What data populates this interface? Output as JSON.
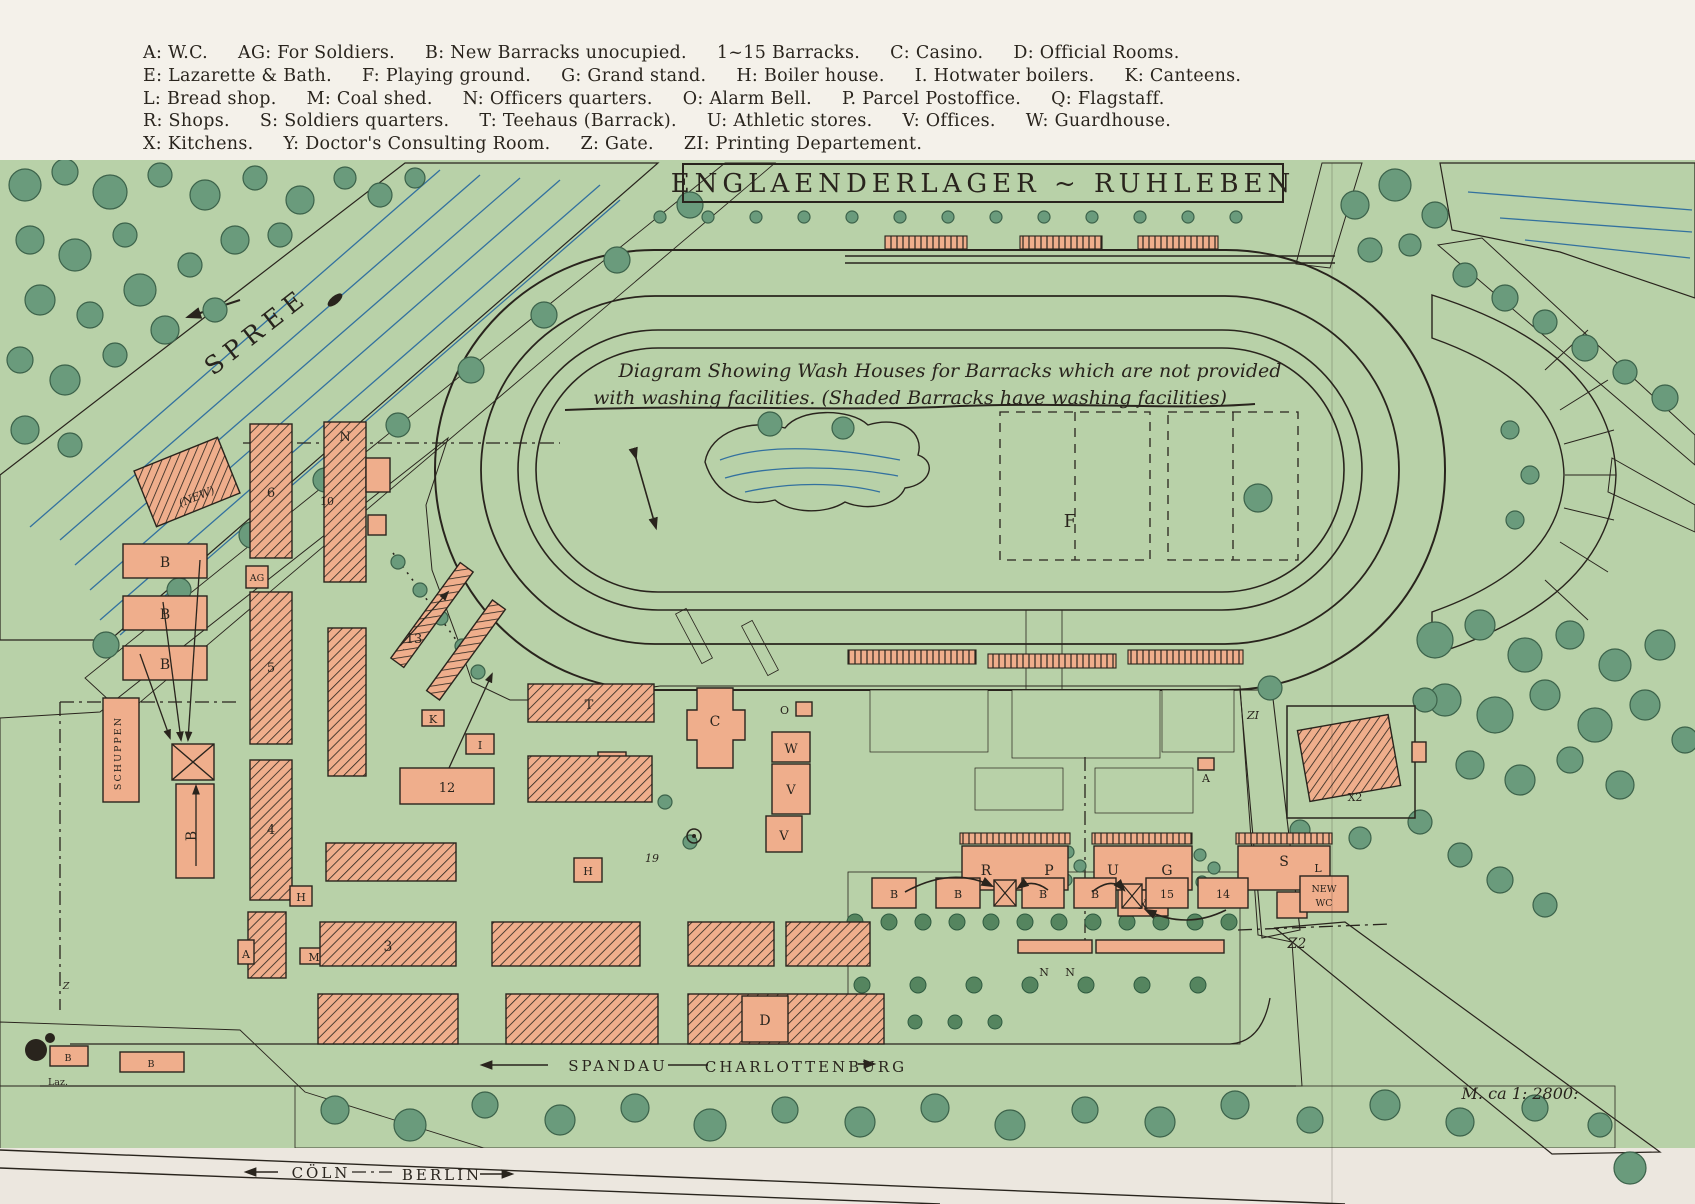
{
  "colors": {
    "paper": "#ece7df",
    "legend_paper": "#f4f1ea",
    "green": "#b8d1a8",
    "tree": "#6a9b7c",
    "bush": "#55855f",
    "water": "#7fc3e9",
    "water_line": "#33719f",
    "building": "#efae8c",
    "ink": "#29241d"
  },
  "legend": {
    "lines": [
      [
        "A: W.C.",
        "AG: For Soldiers.",
        "B: New Barracks unocupied.",
        "1~15 Barracks.",
        "C: Casino.",
        "D: Official Rooms."
      ],
      [
        "E: Lazarette & Bath.",
        "F: Playing ground.",
        "G: Grand stand.",
        "H: Boiler house.",
        "I. Hotwater boilers.",
        "K: Canteens."
      ],
      [
        "L: Bread shop.",
        "M: Coal shed.",
        "N: Officers quarters.",
        "O: Alarm Bell.",
        "P. Parcel Postoffice.",
        "Q: Flagstaff."
      ],
      [
        "R: Shops.",
        "S: Soldiers quarters.",
        "T: Teehaus (Barrack).",
        "U: Athletic stores.",
        "V: Offices.",
        "W: Guardhouse."
      ],
      [
        "X: Kitchens.",
        "Y: Doctor's Consulting Room.",
        "Z: Gate.",
        "ZI: Printing Departement."
      ]
    ]
  },
  "title": "ENGLAENDERLAGER ~ RUHLEBEN",
  "annotation": {
    "line1": "Diagram Showing Wash Houses for Barracks which are not provided",
    "line2": "with washing facilities. (Shaded Barracks have washing facilities)"
  },
  "map_labels": {
    "spree": "SPREE",
    "field": "F",
    "new_building": "(NEW)",
    "schuppen": "SCHUPPEN",
    "a": "A",
    "ag": "AG",
    "b": "B",
    "c": "C",
    "d": "D",
    "g": "G",
    "h": "H",
    "i": "I",
    "k": "K",
    "ke": "KE",
    "l": "L",
    "m": "M",
    "n": "N",
    "o": "O",
    "p": "P",
    "r": "R",
    "s": "S",
    "t": "T",
    "u": "U",
    "v": "V",
    "w": "W",
    "x": "X",
    "x2": "X2",
    "zi": "ZI",
    "num3": "3",
    "num4": "4",
    "num5": "5",
    "num6": "6",
    "num10": "10",
    "num12": "12",
    "num13": "13",
    "num14": "14",
    "num15": "15",
    "note_near_flagstaff": "19",
    "laz": "Laz.",
    "new_wc_1": "NEW",
    "new_wc_2": "WC",
    "z": "Z",
    "z2": "Z2",
    "road_west": "SPANDAU",
    "road_east": "CHARLOTTENBURG",
    "rail_west": "CÖLN",
    "rail_east": "BERLIN",
    "scale": "M. ca 1: 2800:"
  }
}
